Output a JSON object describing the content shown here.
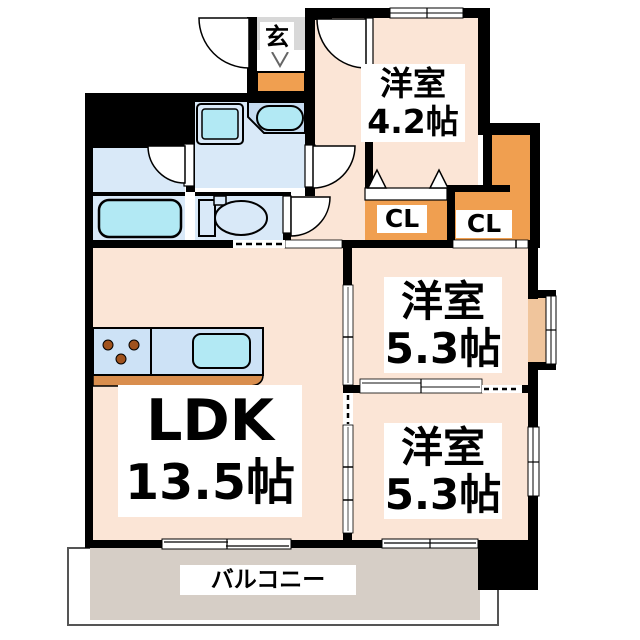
{
  "title": "apartment-floor-plan",
  "rooms": {
    "genkan": {
      "label": "玄"
    },
    "room_4_2": {
      "label": "洋室",
      "size": "4.2帖"
    },
    "closet_left": {
      "label": "CL"
    },
    "closet_right": {
      "label": "CL"
    },
    "room_5_3_upper": {
      "label": "洋室",
      "size": "5.3帖"
    },
    "room_5_3_lower": {
      "label": "洋室",
      "size": "5.3帖"
    },
    "ldk": {
      "label": "LDK",
      "size": "13.5帖"
    },
    "balcony": {
      "label": "バルコニー"
    }
  },
  "fixtures": [
    "bathtub",
    "toilet",
    "wash-basin",
    "washing-machine-pan",
    "kitchen-counter",
    "sink",
    "stove"
  ],
  "colors": {
    "wall": "#000000",
    "room_peach": "#fbe5d6",
    "water_blue": "#d9e9f8",
    "counter_blue": "#cde2f6",
    "fixture_cyan": "#b2e9f4",
    "closet_orange": "#f09f50",
    "balcony_gray": "#d6cec6",
    "genkan_gray": "#d8d8d8",
    "counter_brown": "#d98e4e",
    "bay_sill": "#f0c59c",
    "burner_brown": "#a0521d"
  }
}
